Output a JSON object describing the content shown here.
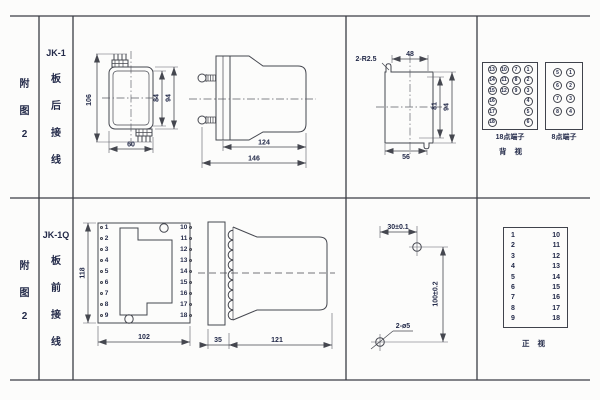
{
  "sheet": {
    "row1": {
      "figure_chars": [
        "附",
        "图",
        "2"
      ],
      "model": "JK-1",
      "wiring_chars": [
        "板",
        "后",
        "接",
        "线"
      ],
      "rear_view": {
        "dim_total_height": "106",
        "dim_inner_height": "84",
        "dim_outer_height": "94",
        "dim_width": "60"
      },
      "side_view": {
        "dim_body_length": "124",
        "dim_total_length": "146"
      },
      "cutout_view": {
        "slot_note": "2-R2.5",
        "dim_slot_span": "48",
        "dim_inner_height": "81",
        "dim_outer_height": "94",
        "dim_bottom_width": "56"
      },
      "terminal_block_18": {
        "caption": "18点端子",
        "cells": [
          "13",
          "10",
          "7",
          "1",
          "14",
          "11",
          "8",
          "2",
          "15",
          "12",
          "9",
          "3",
          "16",
          "",
          "",
          "4",
          "17",
          "",
          "",
          "5",
          "18",
          "",
          "",
          "6"
        ]
      },
      "terminal_block_8": {
        "caption": "8点端子",
        "cells": [
          "5",
          "1",
          "6",
          "2",
          "7",
          "3",
          "8",
          "4"
        ]
      },
      "view_caption": "背 视"
    },
    "row2": {
      "figure_chars": [
        "附",
        "图",
        "2"
      ],
      "model": "JK-1Q",
      "wiring_chars": [
        "板",
        "前",
        "接",
        "线"
      ],
      "panel_view": {
        "dim_height": "118",
        "dim_width": "102",
        "left_terminals": [
          "1",
          "2",
          "3",
          "4",
          "5",
          "6",
          "7",
          "8",
          "9"
        ],
        "right_terminals": [
          "10",
          "11",
          "12",
          "13",
          "14",
          "15",
          "16",
          "17",
          "18"
        ]
      },
      "side_view": {
        "dim_front_depth": "35",
        "dim_body_length": "121"
      },
      "drill_view": {
        "dim_horizontal": "30±0.1",
        "dim_vertical": "100±0.2",
        "hole_note": "2-ø5"
      },
      "front_view": {
        "caption": "正 视",
        "left_terminals": [
          "1",
          "2",
          "3",
          "4",
          "5",
          "6",
          "7",
          "8",
          "9"
        ],
        "right_terminals": [
          "10",
          "11",
          "12",
          "13",
          "14",
          "15",
          "16",
          "17",
          "18"
        ]
      }
    }
  }
}
